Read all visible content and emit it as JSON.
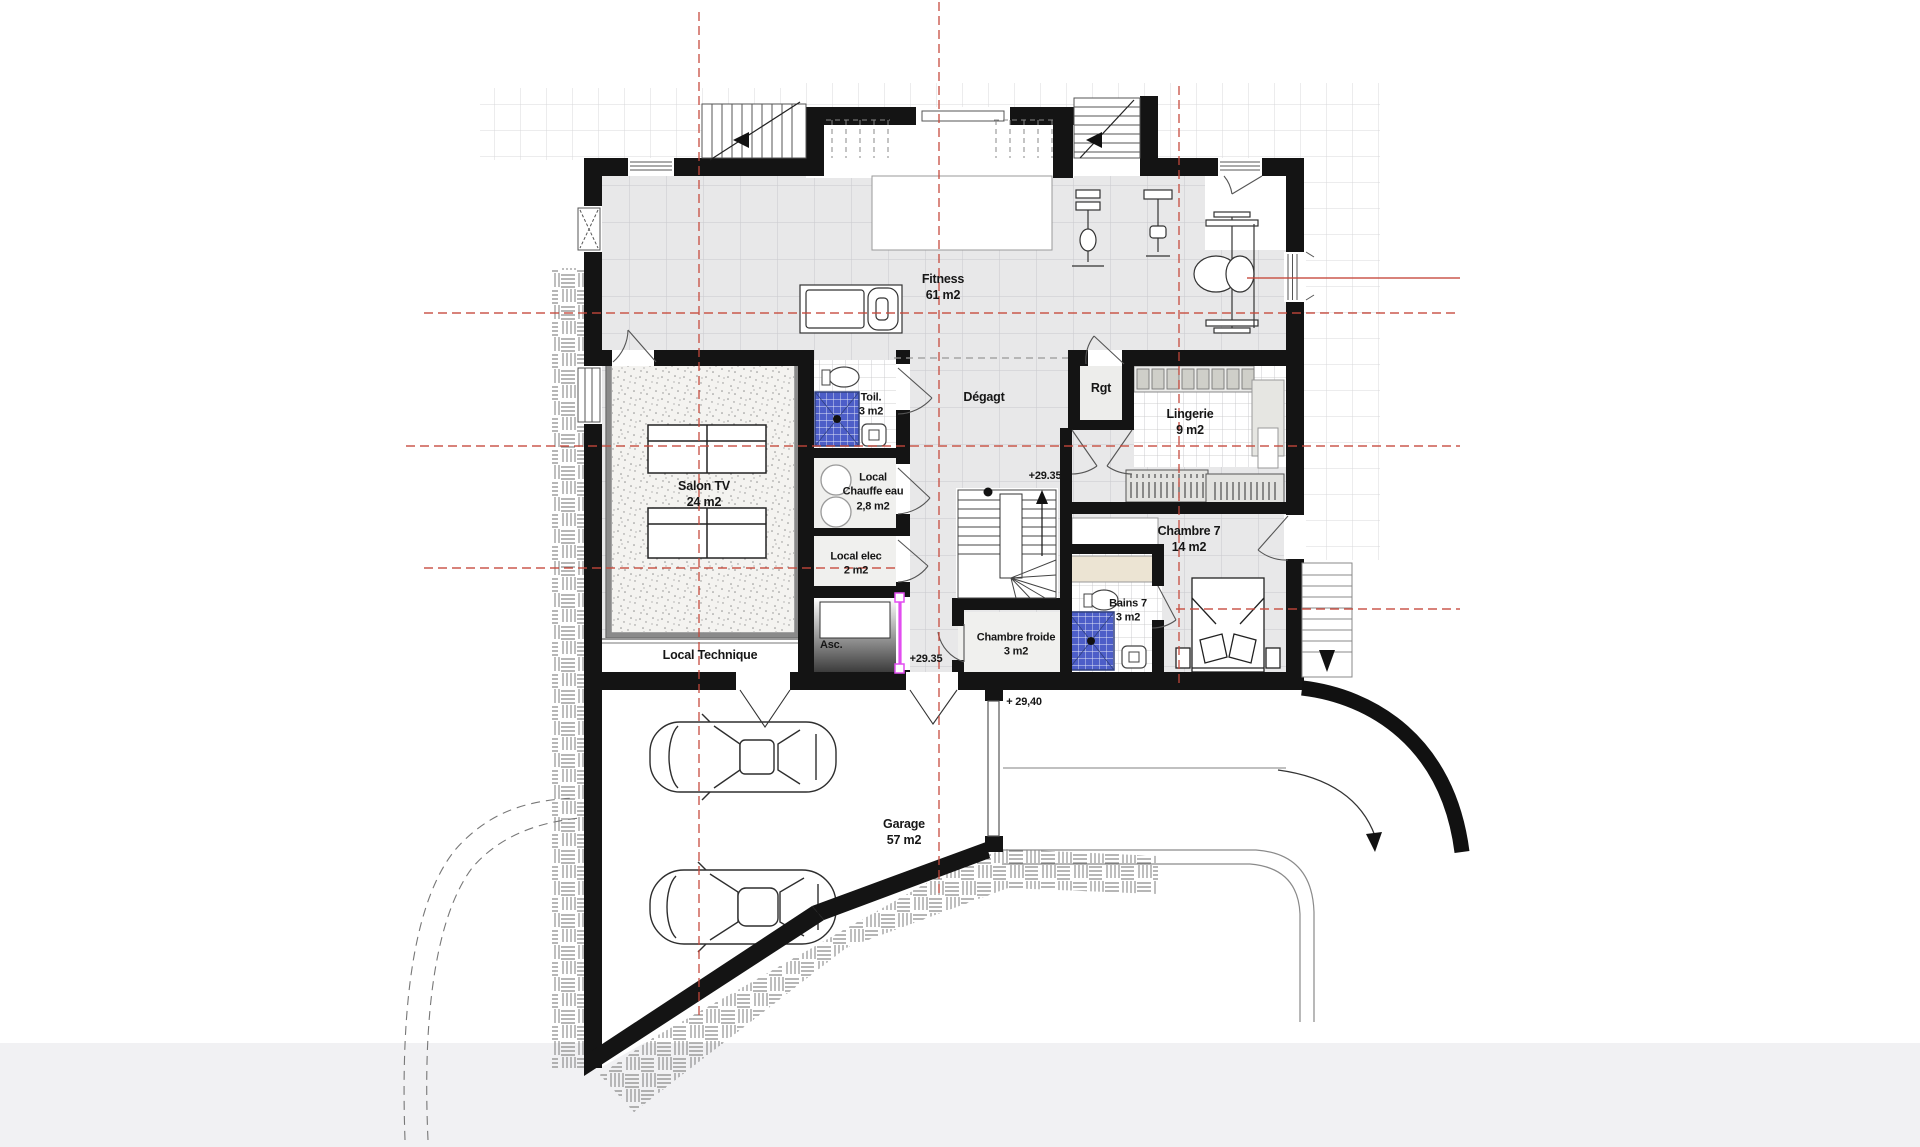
{
  "plan": {
    "type": "architectural-floor-plan",
    "level": "basement",
    "colors": {
      "wall": "#141414",
      "floor_tile": "#e8e8e9",
      "tile_grid_line": "#c9c9cd",
      "exterior_grid_line": "#dcdcde",
      "carpet": "#f4f3f0",
      "shower_blue": "#4d5ec8",
      "elevator_door_magenta": "#e24df0",
      "axis_red": "#c6483a",
      "counter_beige": "#ece4d3",
      "bottom_band": "#f1f1f3"
    },
    "rooms": {
      "fitness": {
        "name": "Fitness",
        "area": "61 m2"
      },
      "toilette": {
        "name": "Toil.",
        "area": "3 m2"
      },
      "degagement": {
        "name": "Dégagt"
      },
      "rangement": {
        "name": "Rgt"
      },
      "lingerie": {
        "name": "Lingerie",
        "area": "9 m2"
      },
      "salon_tv": {
        "name": "Salon TV",
        "area": "24 m2"
      },
      "chauffe_eau": {
        "name": "Local",
        "name2": "Chauffe eau",
        "area": "2,8 m2"
      },
      "local_elec": {
        "name": "Local elec",
        "area": "2 m2"
      },
      "chambre7": {
        "name": "Chambre 7",
        "area": "14 m2"
      },
      "bains7": {
        "name": "Bains 7",
        "area": "3 m2"
      },
      "chambre_froide": {
        "name": "Chambre froide",
        "area": "3 m2"
      },
      "ascenseur": {
        "name": "Asc."
      },
      "local_technique": {
        "name": "Local Technique"
      },
      "garage": {
        "name": "Garage",
        "area": "57 m2"
      }
    },
    "levels": {
      "upper": "+29.35",
      "lower": "+29.35",
      "apron": "+ 29,40"
    }
  }
}
